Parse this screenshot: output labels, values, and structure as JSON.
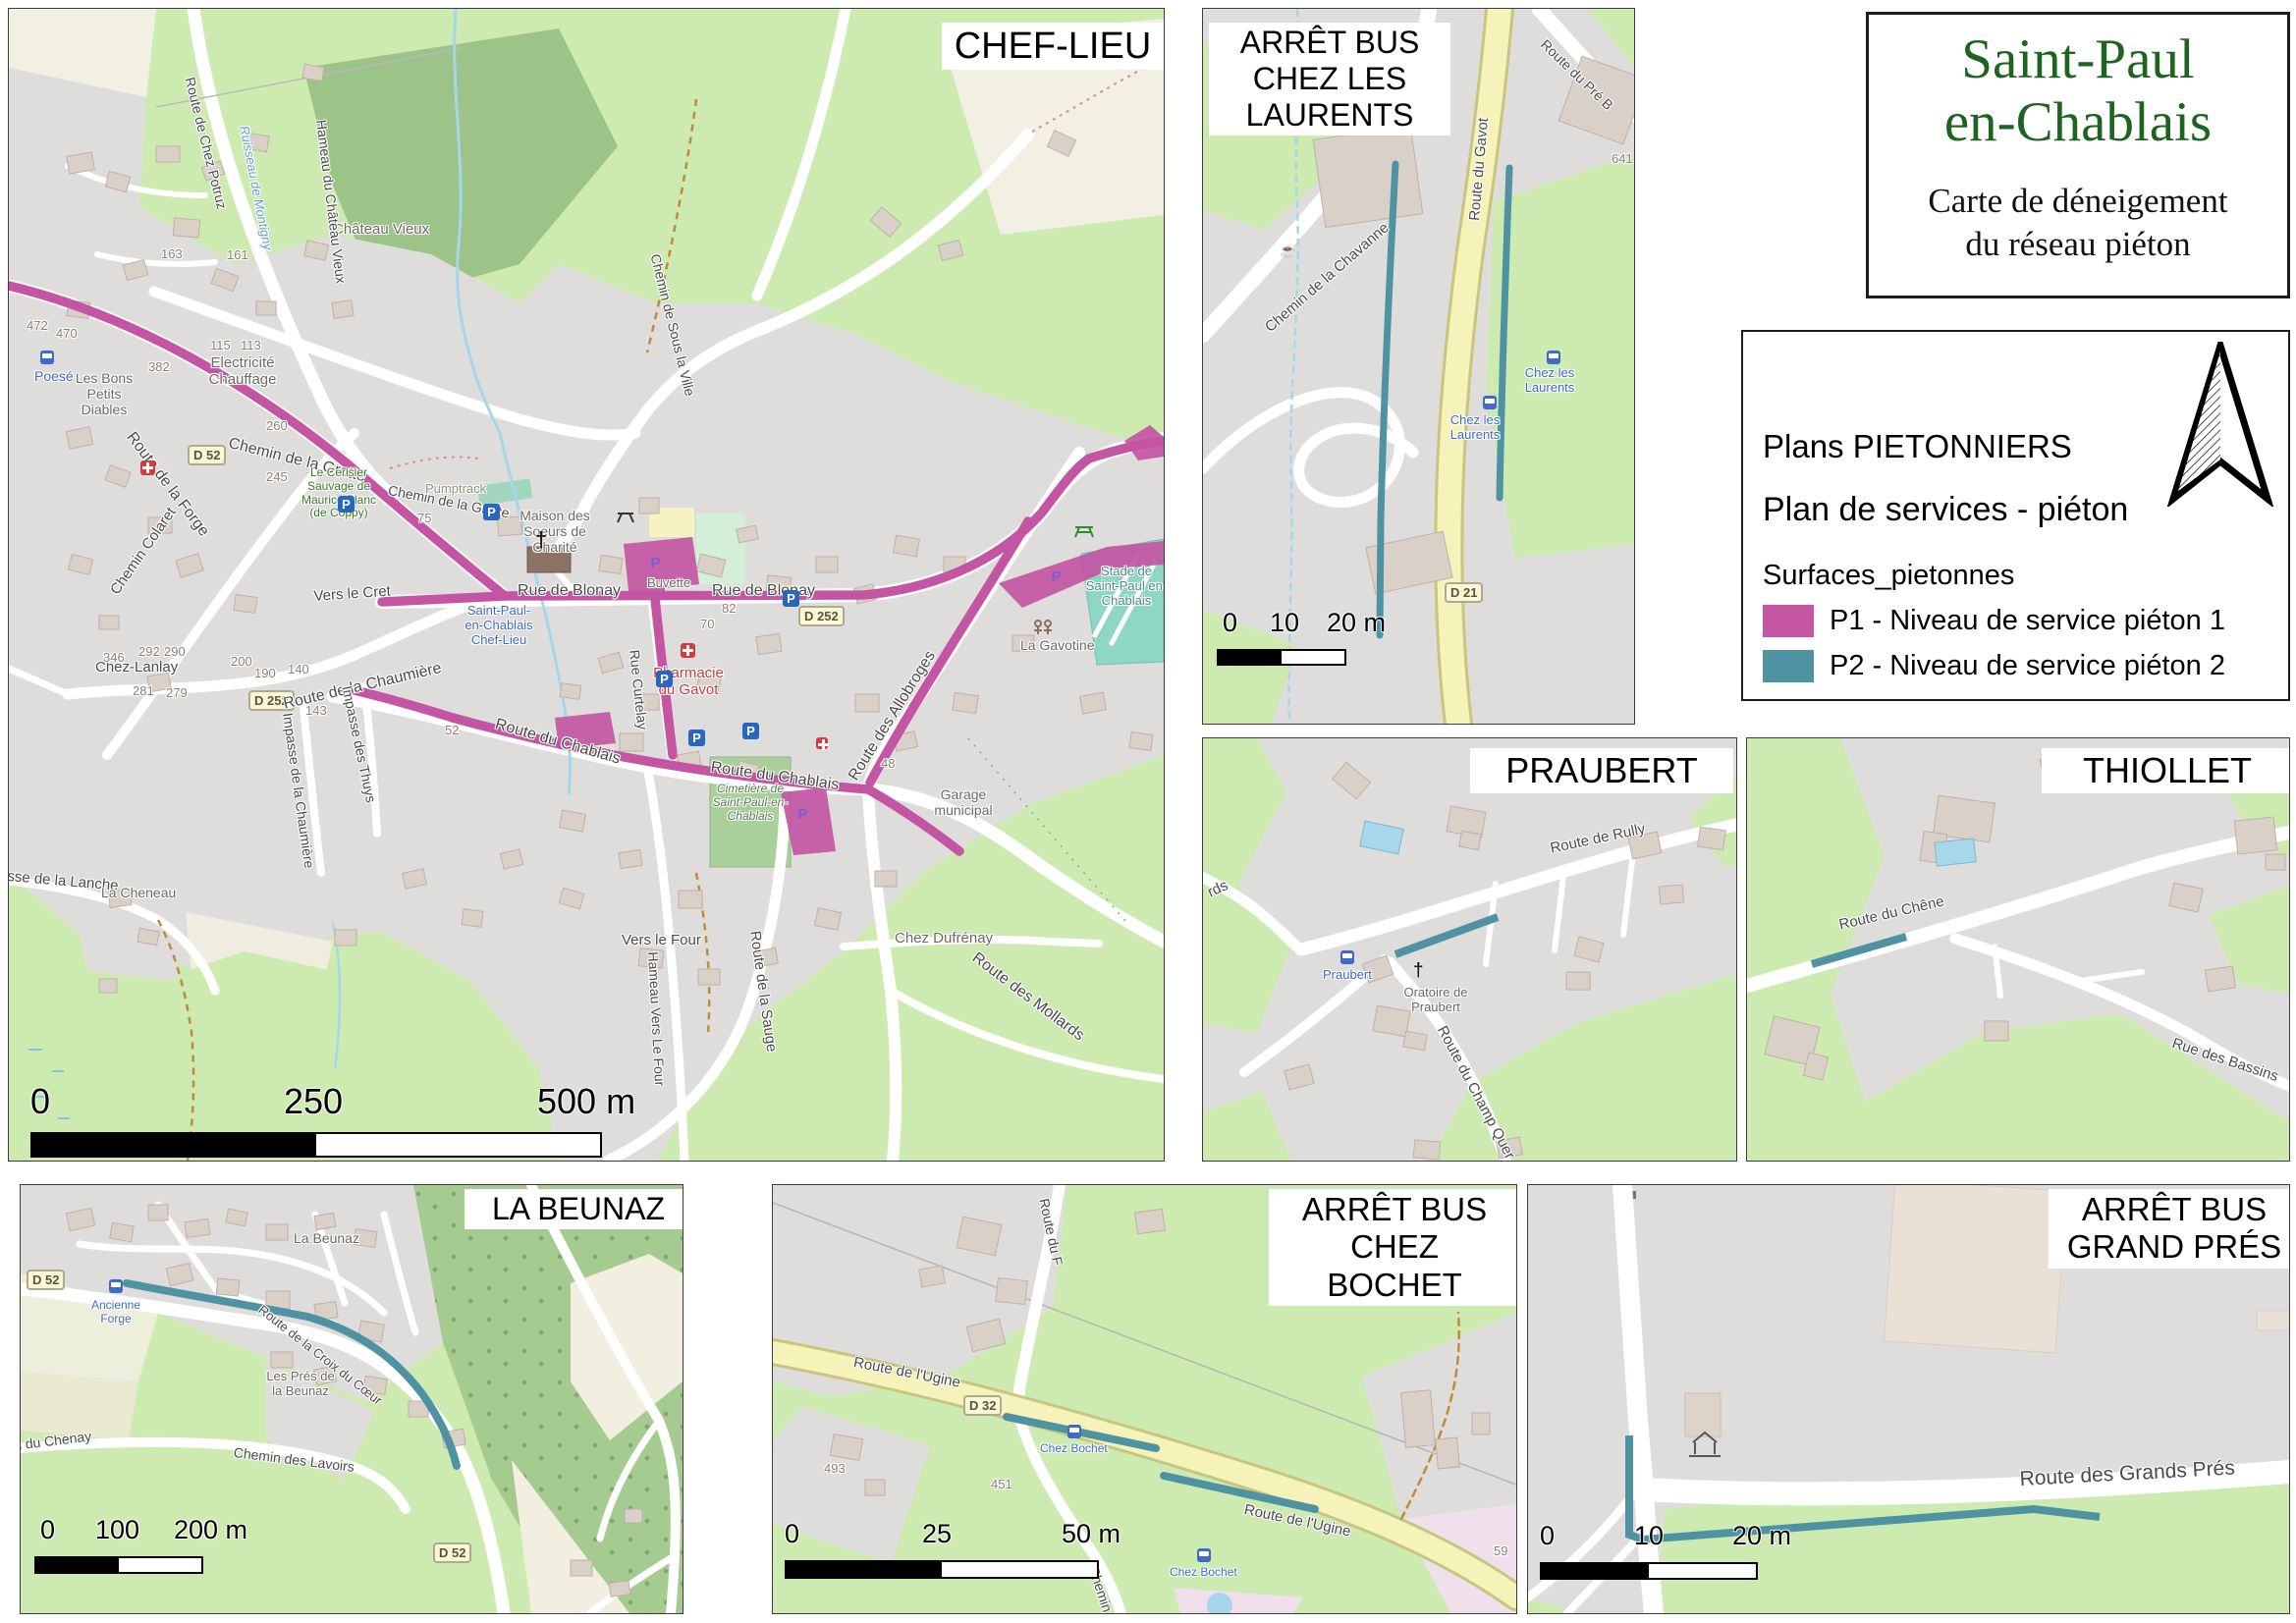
{
  "document": {
    "title": "Saint-Paul\nen-Chablais",
    "subtitle": "Carte de déneigement\ndu réseau piéton"
  },
  "legend": {
    "heading1": "Plans PIETONNIERS",
    "heading2": "Plan de services - piéton",
    "group_label": "Surfaces_pietonnes",
    "items": [
      {
        "code": "P1",
        "label": "P1 - Niveau de service piéton 1",
        "color": "#c355a3"
      },
      {
        "code": "P2",
        "label": "P2 - Niveau de service piéton 2",
        "color": "#4f93a3"
      }
    ]
  },
  "icons": {
    "parking": "P",
    "cross": "†",
    "cafe": "☕"
  },
  "colors": {
    "p1": "#c355a3",
    "p2": "#4f93a3",
    "road_yellow": "#f5f3ba",
    "land_grey": "#dedddb",
    "land_green": "#cdebb0",
    "forest_green": "#a5cb91",
    "water_blue": "#a6d5ec",
    "bus_blue": "#3e6bc8",
    "poi_red": "#cc3b3b",
    "title_green": "#1e6420",
    "building": "#d9d0c8"
  },
  "panels": {
    "chef_lieu": {
      "title": "CHEF-LIEU",
      "scalebar": {
        "t0": "0",
        "t1": "250",
        "t2": "500 m"
      },
      "labels": {
        "poese": "Poesé",
        "les_bons": "Les Bons Petits Diables",
        "route_forge": "Route de la Forge",
        "electricite": "Electricité Chauffage",
        "chemin_grotte": "Chemin de la Grotte",
        "chateau_vieux": "Château Vieux",
        "hameau_chateau_vieux": "Hameau du Château Vieux",
        "route_chez_potruz": "Route de Chez Potruz",
        "ruisseau": "Ruisseau de Montigny",
        "chemin_sous_la_ville": "Chemin de Sous la Ville",
        "cerisier": "Le Cerisier Sauvage de Maurice Blanc (de Coppy)",
        "pumptrack": "Pumptrack",
        "maison_soeurs": "Maison des Soeurs de Charité",
        "buvette": "Buvette",
        "rue_blonay": "Rue de Blonay",
        "chef_lieu_stop": "Saint-Paul-en-Chablais Chef-Lieu",
        "vers_le_cret": "Vers le Cret",
        "chemin_colaret": "Chemin Colaret",
        "chez_lanlay": "Chez-Lanlay",
        "route_chaumiere": "Route de la Chaumière",
        "impasse_chaumiere": "Impasse de la Chaumière",
        "impasse_thuys": "Impasse des Thuys",
        "impasse_lanche": "Impasse de la Lanche",
        "la_cheneau": "La Cheneau",
        "rue_curtelay": "Rue Curtelay",
        "pharmacie": "Pharmacie du Gavot",
        "route_chablais": "Route du Chablais",
        "route_allobroges": "Route des Allobroges",
        "cimetiere": "Cimetière de Saint-Paul-en-Chablais",
        "vers_le_four": "Vers le Four",
        "hameau_vers_le_four": "Hameau Vers Le Four",
        "route_sauge": "Route de la Sauge",
        "chez_dufrenay": "Chez Dufrénay",
        "garage": "Garage municipal",
        "route_mollards": "Route des Mollards",
        "stade": "Stade de Saint-Paul en-Chablais",
        "la_gavotine": "La Gavotine",
        "d252": "D 252",
        "d52": "D 52"
      },
      "house_numbers": [
        "163",
        "161",
        "115",
        "113",
        "382",
        "472",
        "470",
        "260",
        "245",
        "52",
        "82",
        "70",
        "48",
        "292",
        "290",
        "346",
        "281",
        "279",
        "200",
        "190",
        "140",
        "143",
        "75"
      ]
    },
    "laurents": {
      "title": "ARRÊT BUS\nCHEZ LES\nLAURENTS",
      "scalebar": {
        "t0": "0",
        "t1": "10",
        "t2": "20 m"
      },
      "labels": {
        "route_gavot": "Route du Gavot",
        "route_pre": "Route du Pré B",
        "chemin_chavanne": "Chemin de la Chavanne",
        "chez_les_laurents": "Chez les Laurents",
        "d21": "D 21",
        "n641": "641"
      }
    },
    "praubert": {
      "title": "PRAUBERT",
      "labels": {
        "route_rully": "Route de Rully",
        "route_champ": "Route du Champ Quer",
        "frag_mollards": "rds",
        "stop": "Praubert",
        "oratoire": "Oratoire de Praubert"
      }
    },
    "thiollet": {
      "title": "THIOLLET",
      "labels": {
        "route_chene": "Route du Chêne",
        "rue_bassins": "Rue des Bassins"
      }
    },
    "beunaz": {
      "title": "LA BEUNAZ",
      "scalebar": {
        "t0": "0",
        "t1": "100",
        "t2": "200 m"
      },
      "labels": {
        "la_beunaz": "La Beunaz",
        "route_croix": "Route de la Croix du Cœur",
        "chemin_lavoirs": "Chemin des Lavoirs",
        "les_pres": "Les Prés de la Beunaz",
        "ancienne_forge": "Ancienne Forge",
        "chemin_chenay": "Chemin du Chenay",
        "d52": "D 52"
      }
    },
    "bochet": {
      "title": "ARRÊT BUS\nCHEZ BOCHET",
      "scalebar": {
        "t0": "0",
        "t1": "25",
        "t2": "50 m"
      },
      "labels": {
        "route_ugine": "Route de l'Ugine",
        "d32": "D 32",
        "chez_bochet": "Chez Bochet",
        "route_du": "Route du F",
        "chemin_mou": "Chemin du Mou",
        "n493": "493",
        "n451": "451",
        "n59": "59"
      }
    },
    "grand_pres": {
      "title": "ARRÊT BUS\nGRAND PRÉS",
      "scalebar": {
        "t0": "0",
        "t1": "10",
        "t2": "20 m"
      },
      "labels": {
        "route_grands_pres": "Route des Grands Prés"
      }
    }
  }
}
